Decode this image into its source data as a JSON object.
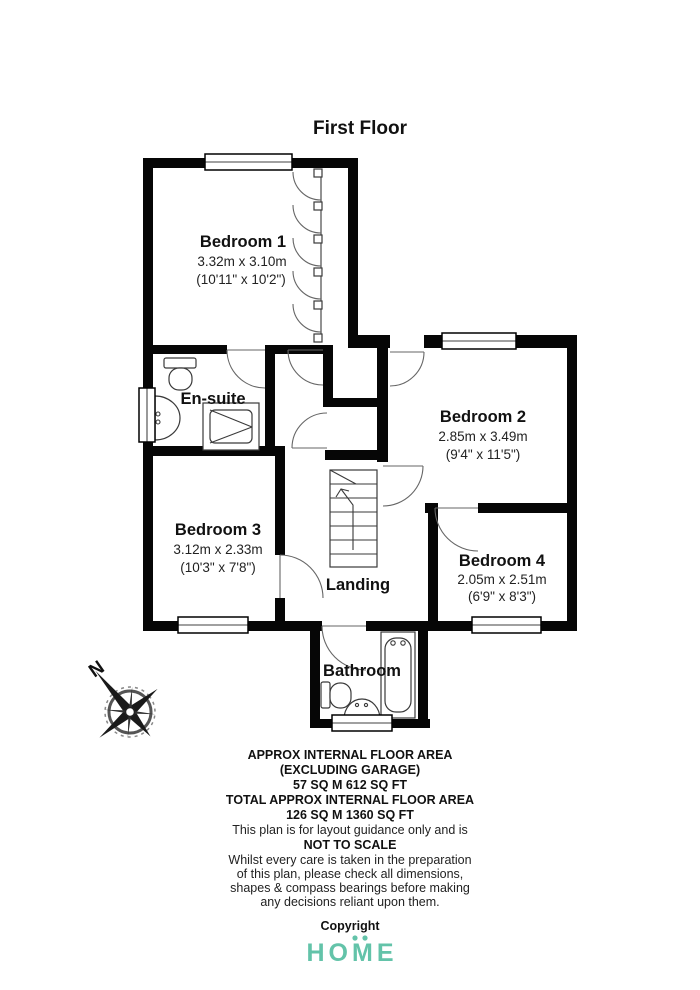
{
  "title": "First Floor",
  "rooms": {
    "bedroom1": {
      "name": "Bedroom 1",
      "metric": "3.32m x 3.10m",
      "imperial": "(10'11\" x 10'2\")"
    },
    "bedroom2": {
      "name": "Bedroom 2",
      "metric": "2.85m x 3.49m",
      "imperial": "(9'4\" x 11'5\")"
    },
    "bedroom3": {
      "name": "Bedroom 3",
      "metric": "3.12m x 2.33m",
      "imperial": "(10'3\" x 7'8\")"
    },
    "bedroom4": {
      "name": "Bedroom 4",
      "metric": "2.05m x 2.51m",
      "imperial": "(6'9\" x 8'3\")"
    },
    "ensuite": {
      "name": "En-suite"
    },
    "landing": {
      "name": "Landing"
    },
    "bathroom": {
      "name": "Bathroom"
    }
  },
  "compass": {
    "label": "N"
  },
  "footer": {
    "line1": "APPROX INTERNAL FLOOR AREA",
    "line2": "(EXCLUDING GARAGE)",
    "line3": "57 SQ M 612 SQ FT",
    "line4": "TOTAL APPROX INTERNAL FLOOR AREA",
    "line5": "126 SQ M 1360 SQ FT",
    "line6": "This plan is for layout guidance only and is",
    "line7": "NOT TO SCALE",
    "line8": "Whilst every care is taken in the preparation",
    "line9": "of this plan, please check all dimensions,",
    "line10": "shapes & compass bearings before making",
    "line11": "any decisions reliant upon them.",
    "line12": "Copyright"
  },
  "logo": {
    "text": "HOME",
    "color": "#63C3A9"
  }
}
